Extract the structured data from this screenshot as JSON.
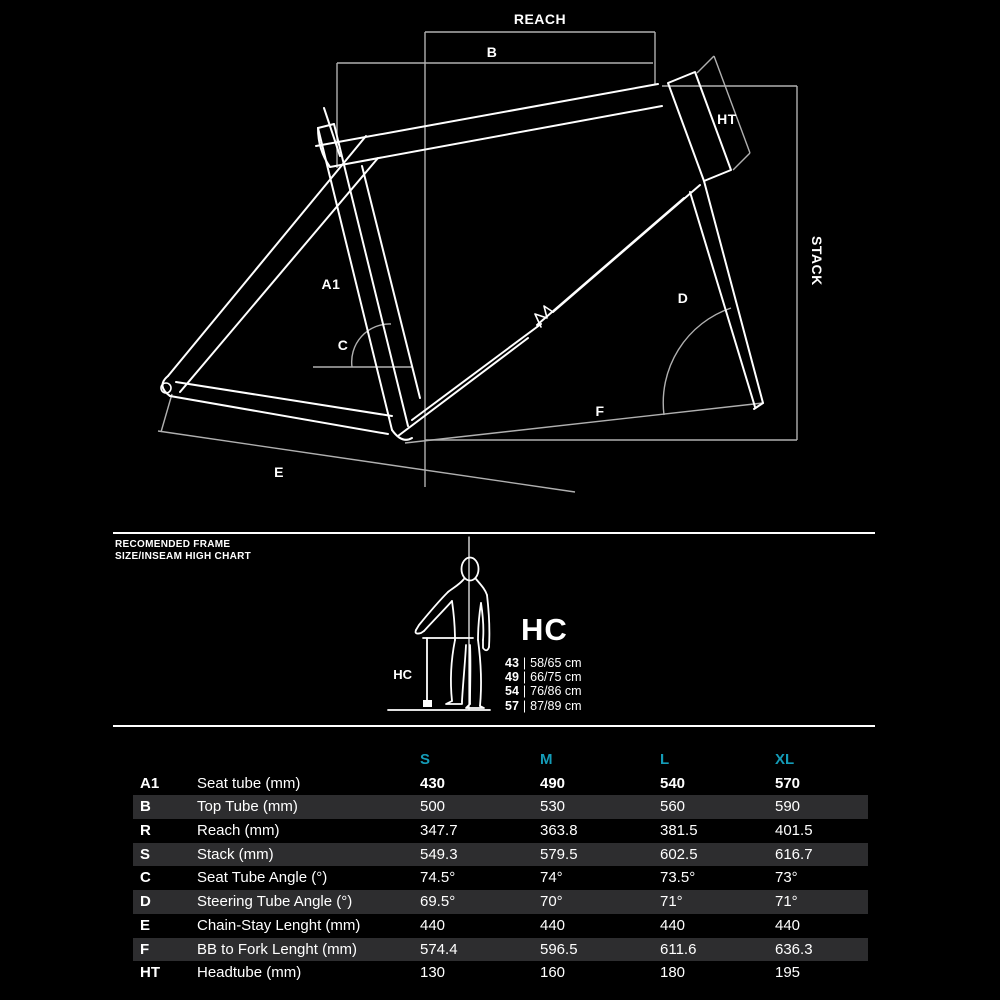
{
  "colors": {
    "background": "#000000",
    "line_white": "#ffffff",
    "dim_line_gray": "#b0b0b0",
    "accent_teal": "#149cb8",
    "row_stripe": "#2d2d2f"
  },
  "diagram": {
    "labels": {
      "reach": "REACH",
      "b": "B",
      "ht": "HT",
      "stack": "STACK",
      "a1": "A1",
      "c": "C",
      "d": "D",
      "e": "E",
      "f": "F"
    }
  },
  "figure": {
    "heading_line1": "RECOMENDED FRAME",
    "heading_line2": "SIZE/INSEAM HIGH CHART",
    "hc_title": "HC",
    "hc_measure_label": "HC",
    "separator": "|",
    "items": [
      {
        "size": "43",
        "range": "58/65 cm"
      },
      {
        "size": "49",
        "range": "66/75 cm"
      },
      {
        "size": "54",
        "range": "76/86 cm"
      },
      {
        "size": "57",
        "range": "87/89 cm"
      }
    ]
  },
  "table": {
    "columns": [
      "S",
      "M",
      "L",
      "XL"
    ],
    "rows": [
      {
        "letter": "A1",
        "name": "Seat tube (mm)",
        "values": [
          "430",
          "490",
          "540",
          "570"
        ]
      },
      {
        "letter": "B",
        "name": "Top Tube (mm)",
        "values": [
          "500",
          "530",
          "560",
          "590"
        ]
      },
      {
        "letter": "R",
        "name": "Reach (mm)",
        "values": [
          "347.7",
          "363.8",
          "381.5",
          "401.5"
        ]
      },
      {
        "letter": "S",
        "name": "Stack (mm)",
        "values": [
          "549.3",
          "579.5",
          "602.5",
          "616.7"
        ]
      },
      {
        "letter": "C",
        "name": "Seat Tube Angle (°)",
        "values": [
          "74.5°",
          "74°",
          "73.5°",
          "73°"
        ]
      },
      {
        "letter": "D",
        "name": "Steering Tube Angle (°)",
        "values": [
          "69.5°",
          "70°",
          "71°",
          "71°"
        ]
      },
      {
        "letter": "E",
        "name": "Chain-Stay Lenght (mm)",
        "values": [
          "440",
          "440",
          "440",
          "440"
        ]
      },
      {
        "letter": "F",
        "name": "BB to Fork Lenght (mm)",
        "values": [
          "574.4",
          "596.5",
          "611.6",
          "636.3"
        ]
      },
      {
        "letter": "HT",
        "name": "Headtube (mm)",
        "values": [
          "130",
          "160",
          "180",
          "195"
        ]
      }
    ]
  }
}
